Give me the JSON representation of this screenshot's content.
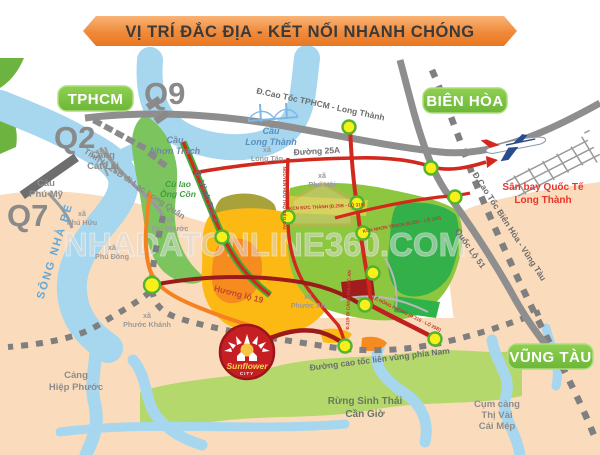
{
  "title": {
    "text": "VỊ TRÍ ĐẮC ĐỊA - KẾT NỐI NHANH CHÓNG"
  },
  "colors": {
    "ribbon_orange": "#ee8434",
    "label_green": "#7cc142",
    "road_red": "#d2281e",
    "road_dark_red": "#9b1b1b",
    "road_orange": "#f58220",
    "road_gray": "#8e8e8e",
    "river_blue": "#a6d7ef",
    "node_yellow": "#f8ef1b",
    "airport_text_red": "#e8352a",
    "land_peach": "#fadcbd"
  },
  "city_labels": {
    "tphcm": "TPHCM",
    "bien_hoa": "BIÊN HÒA",
    "vung_tau": "VŨNG TÀU"
  },
  "route_badges": {
    "q9": "Q9",
    "q2": "Q2",
    "q7": "Q7"
  },
  "roads": {
    "ct_tphcm_lt": "Đ.Cao Tốc TPHCM - Long Thành",
    "ct_bh_vt": "Đ.Cao Tốc Biên Hòa - Vũng Tàu",
    "ql51": "Quốc Lộ 51",
    "d25a": "Đường 25A",
    "lien_vung": "Đường cao tốc liên vùng phía Nam",
    "huong_lo_19": "Hương lộ 19",
    "vanh_dai_3": "Đ. Vành Đai 3",
    "tl25b": "Tỉnh lộ 25B đi Lạc Long Quân"
  },
  "places": {
    "cang_cat_lai": [
      "Cảng",
      "Cát Lái"
    ],
    "cau_phu_my": [
      "Cầu",
      "Phú Mỹ"
    ],
    "cau_nhon_trach": [
      "Cầu",
      "Nhơn Trạch"
    ],
    "cau_long_thanh": [
      "Cầu",
      "Long Thành"
    ],
    "cu_lao_ong_con": [
      "Cù lao",
      "Ông Cồn"
    ],
    "song_nha_be": "SÔNG NHÀ BÈ",
    "san_bay": [
      "Sân bay Quốc Tế",
      "Long Thành"
    ],
    "cang_hiep_phuoc": [
      "Cảng",
      "Hiệp Phước"
    ],
    "rung_sinh_thai": [
      "Rừng Sinh Thái",
      "Cần Giờ"
    ],
    "cum_cang": [
      "Cụm cảng",
      "Thị Vải",
      "Cái Mép"
    ]
  },
  "communes": {
    "phu_huu": [
      "xã",
      "Phú Hữu"
    ],
    "phu_dong": [
      "xã",
      "Phú Đông"
    ],
    "phuoc_khanh": [
      "xã",
      "Phước Khánh"
    ],
    "dai_phuoc": [
      "xã",
      "Đại Phước"
    ],
    "long_tan": [
      "xã",
      "Long Tân"
    ],
    "phu_hoi": [
      "xã",
      "Phú Hội"
    ],
    "phuoc_an": [
      "xã",
      "Phước An"
    ]
  },
  "zones": {
    "z1": "KCN ĐỨC THÀNH (Đ.25B - LỘ 319)",
    "z2": "KCN NHƠN TRẠCH (Đ.25C - LỘ 319)",
    "z3": "LÊ HỒNG PHONG (Đ.319 - LỘ 25B)",
    "z4": "NGUYỄN HỮU THỌ KÉO DÀI",
    "z6": "Đ.319 ĐI CẢNG PHƯỚC AN"
  },
  "logo": {
    "name": "Sunflower",
    "suffix": "CITY"
  },
  "watermark": {
    "text": "NHADATONLINE360.COM"
  }
}
